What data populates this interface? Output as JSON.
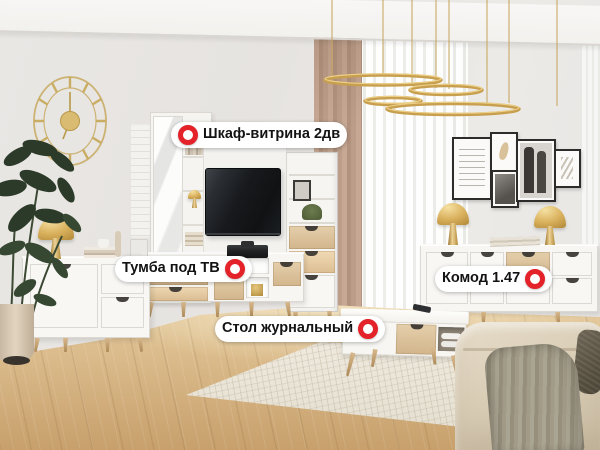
{
  "product_labels": [
    {
      "id": "cabinet",
      "text": "Шкаф-витрина 2дв",
      "marker_side": "left"
    },
    {
      "id": "tv-stand",
      "text": "Тумба под ТВ",
      "marker_side": "right"
    },
    {
      "id": "chest",
      "text": "Комод 1.47",
      "marker_side": "right"
    },
    {
      "id": "coffee-table",
      "text": "Стол журнальный",
      "marker_side": "right"
    }
  ],
  "icons": {
    "hotspot_marker": "red-ring-circle"
  },
  "colors": {
    "marker_red": "#e3222a",
    "pill_bg": "#ffffff",
    "pill_text": "#131313",
    "brass": "#d9b05c",
    "wall": "#e7e4e1",
    "floor_wood": "#d6b384",
    "curtain_taupe": "#bb9d89",
    "furniture_white": "#f7f6f3",
    "oak_front": "#d8bf9b",
    "sofa_beige": "#d9cdb6",
    "throw_sage": "#a09a86",
    "throw_dark": "#57503f",
    "plant_green": "#2f3d2c",
    "tv_black": "#17191c"
  }
}
